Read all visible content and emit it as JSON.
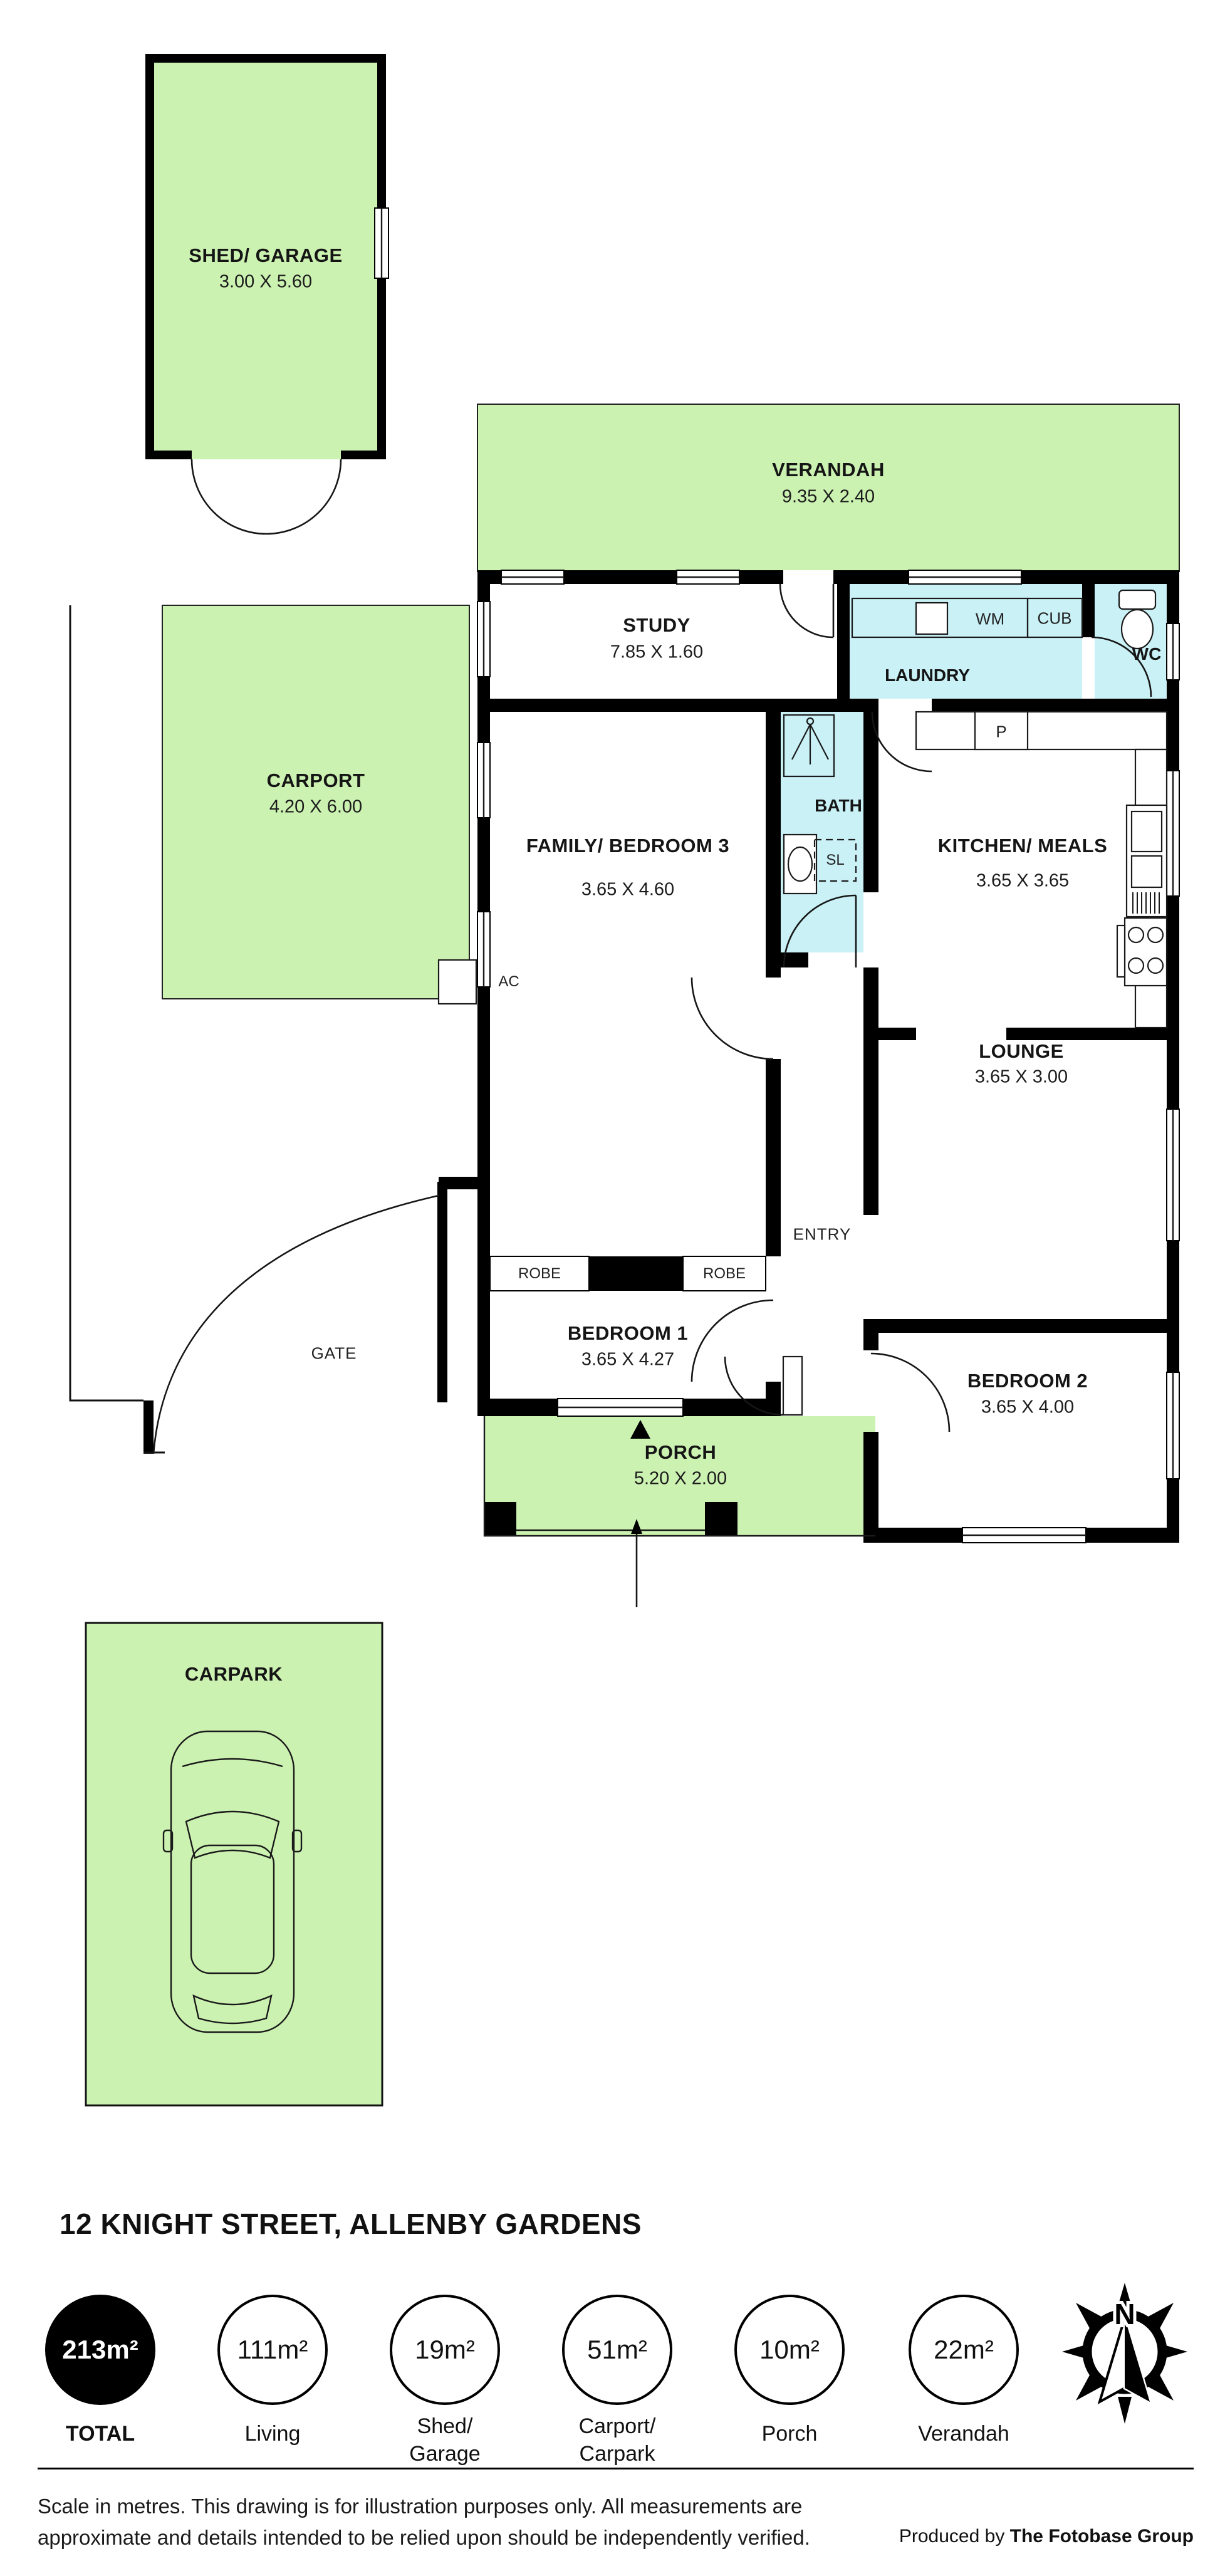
{
  "plan": {
    "shed": {
      "name": "SHED/ GARAGE",
      "dims": "3.00 X 5.60"
    },
    "verandah": {
      "name": "VERANDAH",
      "dims": "9.35 X 2.40"
    },
    "study": {
      "name": "STUDY",
      "dims": "7.85 X 1.60"
    },
    "laundry": {
      "name": "LAUNDRY",
      "wm": "WM",
      "cub": "CUB"
    },
    "wc": {
      "name": "WC"
    },
    "bath": {
      "name": "BATH",
      "sl": "SL"
    },
    "carport": {
      "name": "CARPORT",
      "dims": "4.20 X 6.00"
    },
    "family": {
      "name": "FAMILY/ BEDROOM 3",
      "dims": "3.65 X 4.60"
    },
    "kitchen": {
      "name": "KITCHEN/ MEALS",
      "dims": "3.65 X 3.65",
      "pantry": "P"
    },
    "ac": "AC",
    "robe_left": "ROBE",
    "robe_right": "ROBE",
    "lounge": {
      "name": "LOUNGE",
      "dims": "3.65 X 3.00"
    },
    "entry": "ENTRY",
    "gate": "GATE",
    "bedroom1": {
      "name": "BEDROOM 1",
      "dims": "3.65 X 4.27"
    },
    "bedroom2": {
      "name": "BEDROOM 2",
      "dims": "3.65 X 4.00"
    },
    "porch": {
      "name": "PORCH",
      "dims": "5.20 X 2.00"
    },
    "carpark": {
      "name": "CARPARK"
    }
  },
  "footer": {
    "title": "12 KNIGHT STREET, ALLENBY GARDENS",
    "areas": [
      {
        "value": "213m²",
        "label": "TOTAL",
        "filled": true
      },
      {
        "value": "111m²",
        "label": "Living",
        "filled": false
      },
      {
        "value": "19m²",
        "label": "Shed/\nGarage",
        "filled": false
      },
      {
        "value": "51m²",
        "label": "Carport/\nCarpark",
        "filled": false
      },
      {
        "value": "10m²",
        "label": "Porch",
        "filled": false
      },
      {
        "value": "22m²",
        "label": "Verandah",
        "filled": false
      }
    ],
    "compass_north": "N",
    "disclaimer_line1": "Scale in metres. This drawing is for illustration purposes only. All measurements are",
    "disclaimer_line2": "approximate and details intended to be relied upon should be independently verified.",
    "produced_by": "Produced by ",
    "brand": "The Fotobase Group"
  },
  "colors": {
    "area_green": "#ccf2b2",
    "wet_cyan": "#c9f1f6",
    "wall": "#000000"
  }
}
